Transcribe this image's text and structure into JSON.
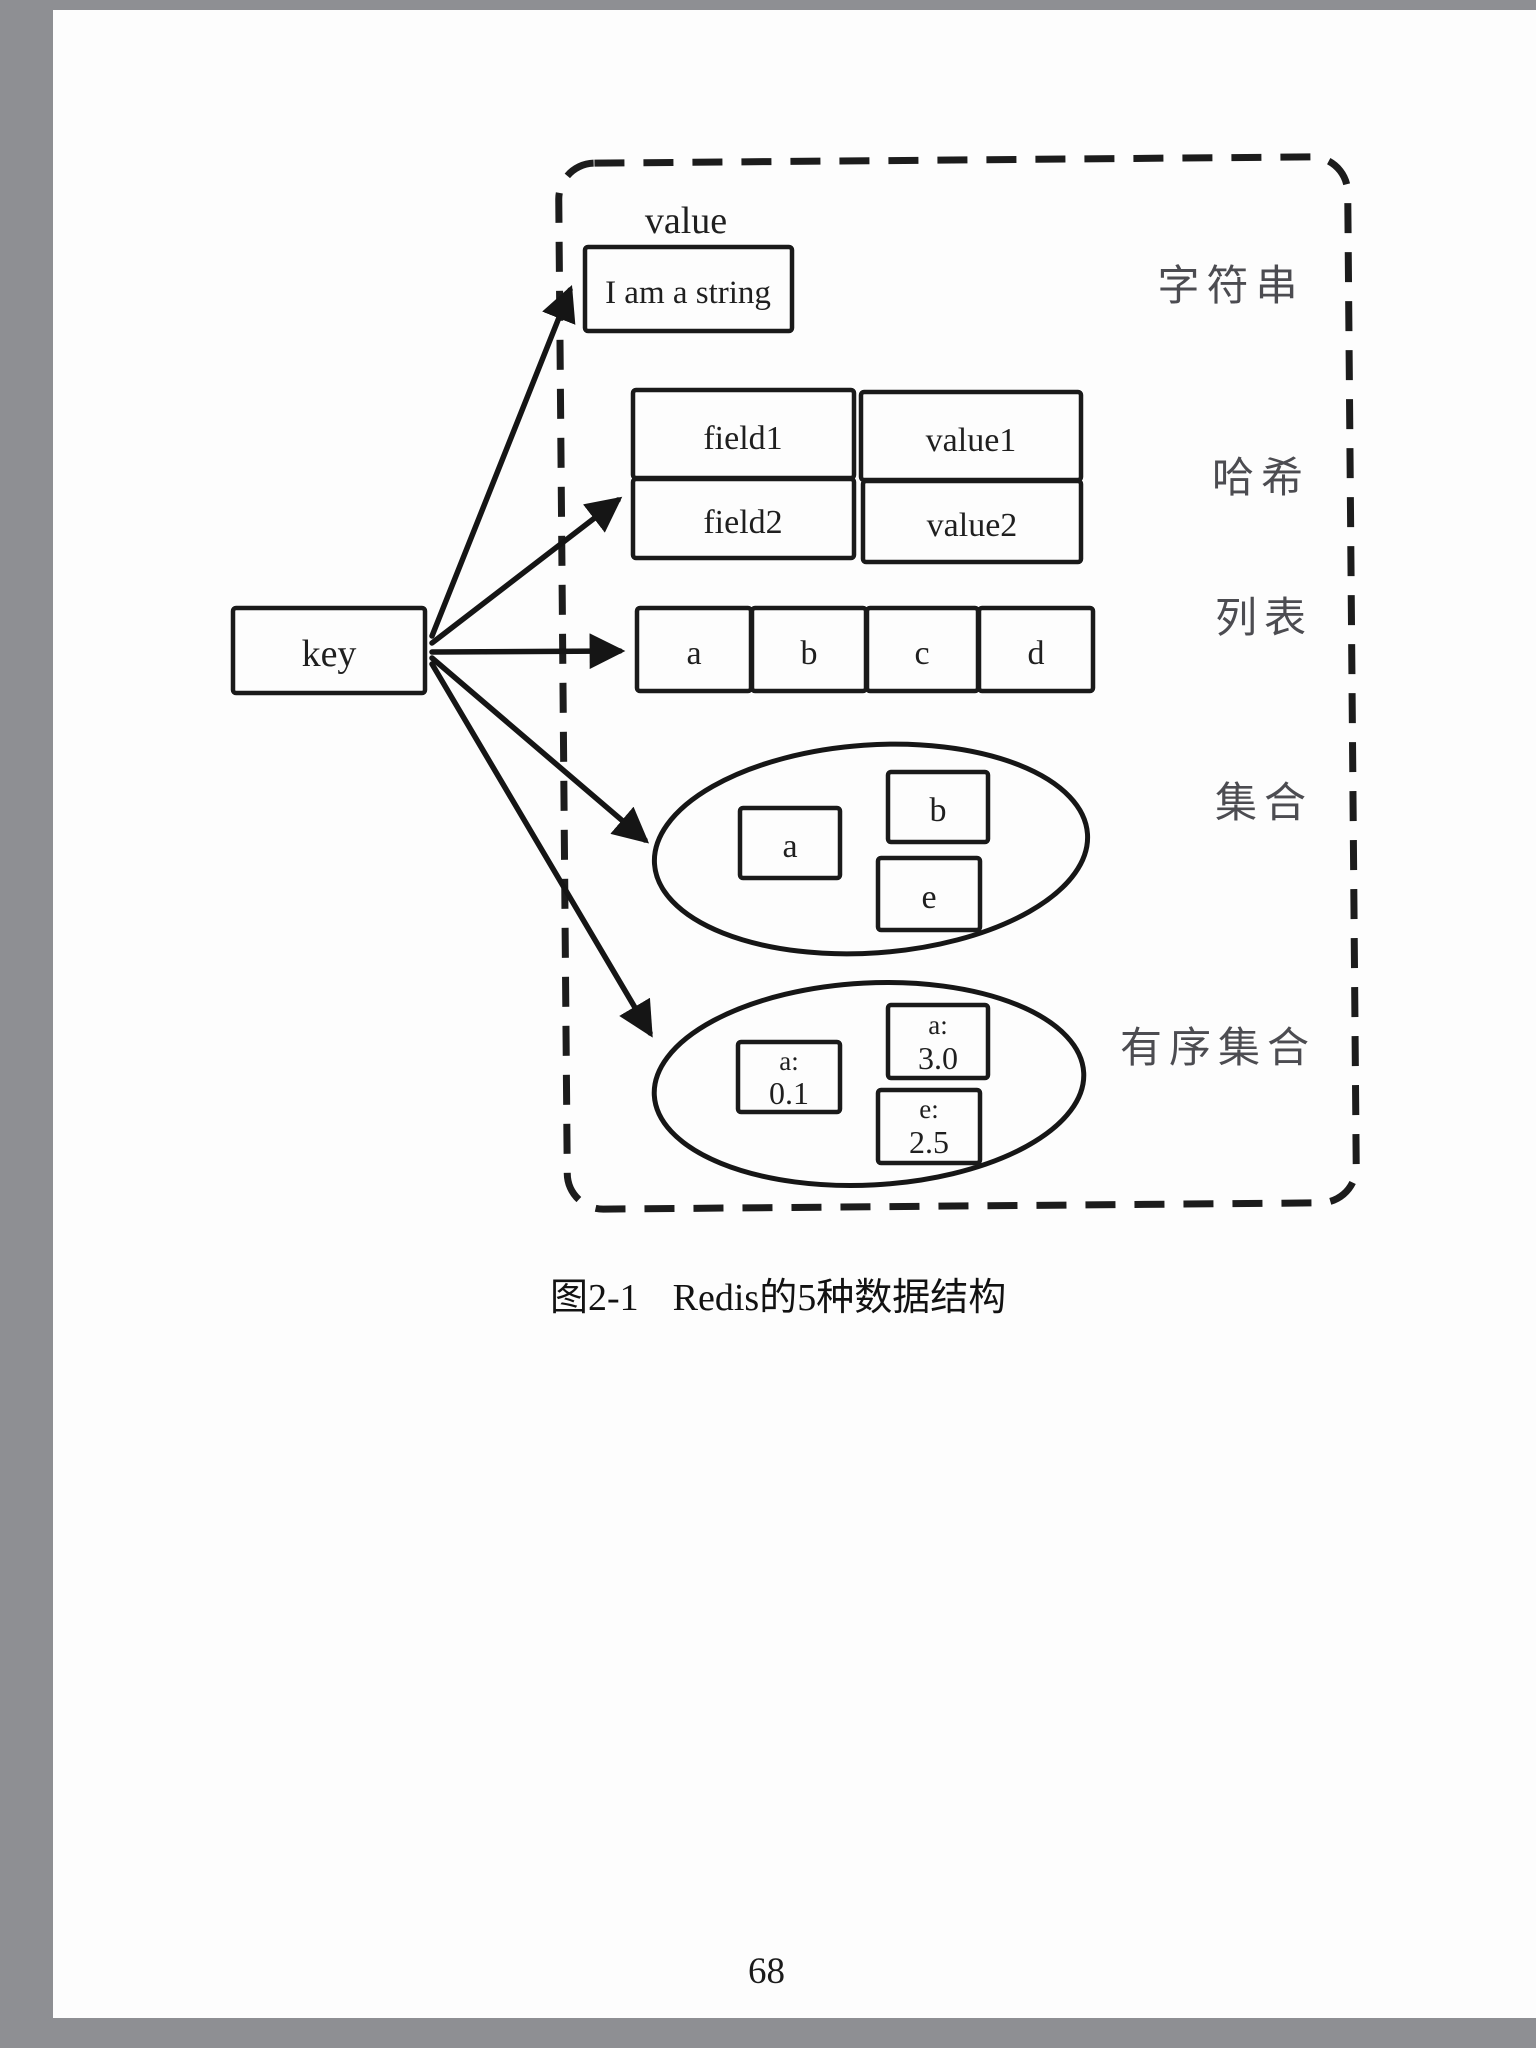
{
  "page": {
    "number": "68",
    "caption": {
      "figure_label": "图2-1",
      "caption_text": "Redis的5种数据结构"
    }
  },
  "diagram": {
    "key_label": "key",
    "value_header": "value",
    "string": {
      "content": "I am a string",
      "type_label": "字符串"
    },
    "hash": {
      "type_label": "哈希",
      "rows": [
        {
          "field": "field1",
          "value": "value1"
        },
        {
          "field": "field2",
          "value": "value2"
        }
      ]
    },
    "list": {
      "type_label": "列表",
      "items": [
        "a",
        "b",
        "c",
        "d"
      ]
    },
    "set": {
      "type_label": "集合",
      "members": [
        "a",
        "b",
        "e"
      ]
    },
    "sorted_set": {
      "type_label": "有序集合",
      "members": [
        {
          "member": "a:",
          "score": "0.1"
        },
        {
          "member": "a:",
          "score": "3.0"
        },
        {
          "member": "e:",
          "score": "2.5"
        }
      ]
    }
  }
}
